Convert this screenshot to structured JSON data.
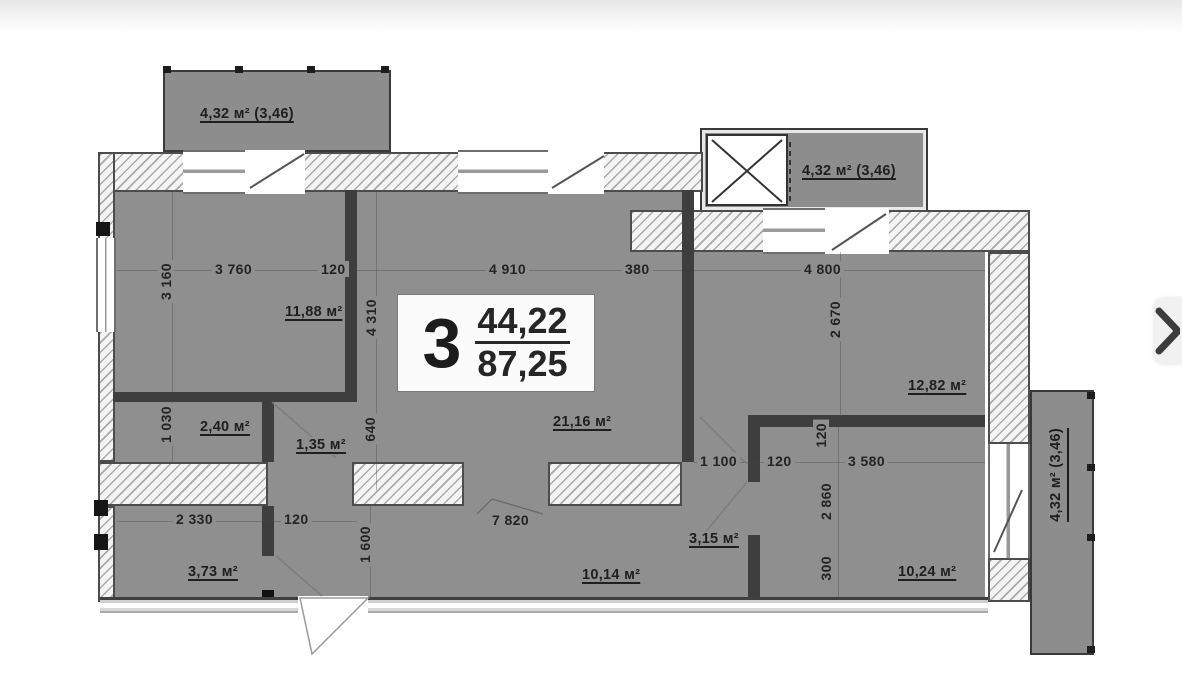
{
  "unit_card": {
    "number": "3",
    "area_living": "44,22",
    "area_total": "87,25"
  },
  "balcony_labels": {
    "top_left": "4,32 м² (3,46)",
    "top_right": "4,32 м² (3,46)",
    "right": "4,32 м² (3,46)"
  },
  "dims": [
    {
      "text": "3 760"
    },
    {
      "text": "120"
    },
    {
      "text": "3 160"
    },
    {
      "text": "4 910"
    },
    {
      "text": "380"
    },
    {
      "text": "4 310"
    },
    {
      "text": "4 800"
    },
    {
      "text": "2 670"
    },
    {
      "text": "1 030"
    },
    {
      "text": "640"
    },
    {
      "text": "1 100"
    },
    {
      "text": "120"
    },
    {
      "text": "3 580"
    },
    {
      "text": "120"
    },
    {
      "text": "2 860"
    },
    {
      "text": "2 330"
    },
    {
      "text": "120"
    },
    {
      "text": "1 600"
    },
    {
      "text": "7 820"
    },
    {
      "text": "300"
    }
  ],
  "areas": [
    {
      "text": "11,88 м²"
    },
    {
      "text": "21,16 м²"
    },
    {
      "text": "12,82 м²"
    },
    {
      "text": "2,40 м²"
    },
    {
      "text": "1,35 м²"
    },
    {
      "text": "3,73 м²"
    },
    {
      "text": "10,14 м²"
    },
    {
      "text": "3,15 м²"
    },
    {
      "text": "10,24 м²"
    }
  ]
}
